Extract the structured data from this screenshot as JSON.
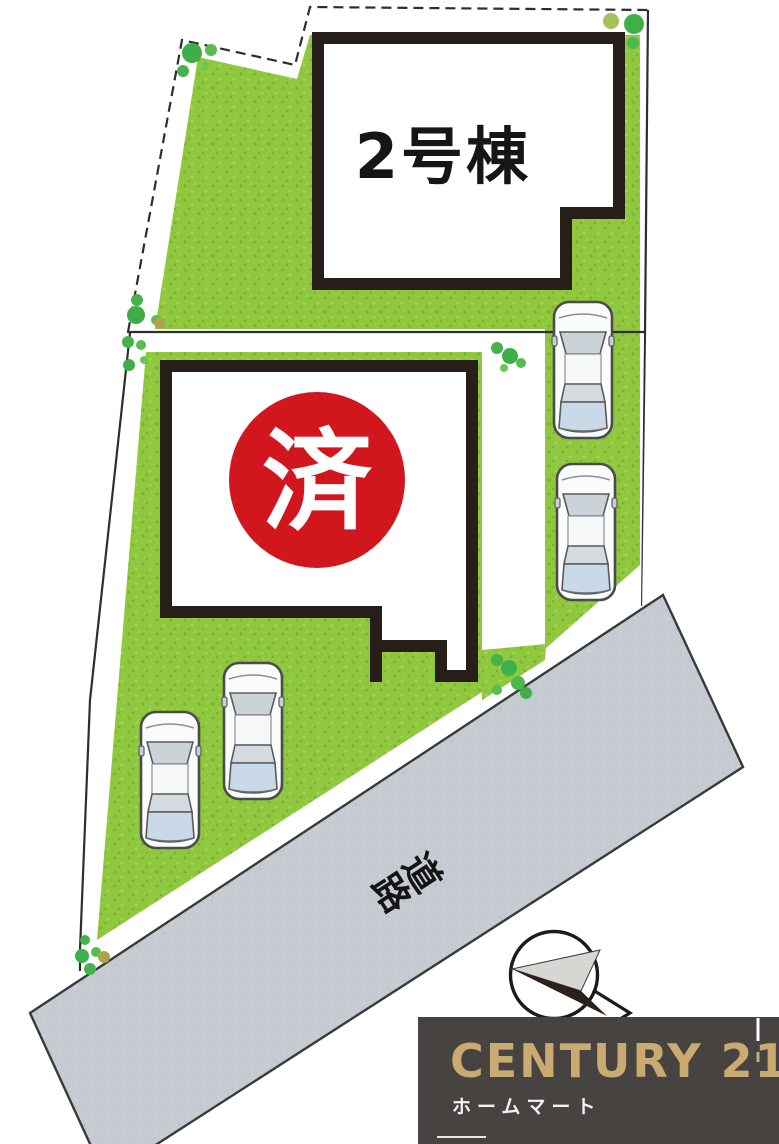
{
  "site_plan": {
    "title_hint": "residential lot layout plan",
    "building2": {
      "label": "2号棟"
    },
    "building1": {
      "badge": "済"
    },
    "road": {
      "label": "道路",
      "char1": "道",
      "char2": "路"
    },
    "cars": {
      "count": 4,
      "description": "white cars top view"
    },
    "compass": {
      "description": "north arrow in circle"
    },
    "colors": {
      "grass": "#8fc73f",
      "grass_dot_dark": "#7cb22f",
      "grass_dot_light": "#a2d656",
      "road_gray": "#c6cbd1",
      "badge_red": "#d2161e",
      "building_border": "#281e19",
      "boundary_line": "#2e2e2e",
      "tree_green": "#3fae49",
      "tree_light": "#6cc555",
      "tree_olive": "#b0a14f"
    }
  },
  "logo": {
    "brand": "CENTURY 21",
    "subtitle": "ホームマート",
    "bg": "#474341",
    "gold": "#c9ab72"
  }
}
